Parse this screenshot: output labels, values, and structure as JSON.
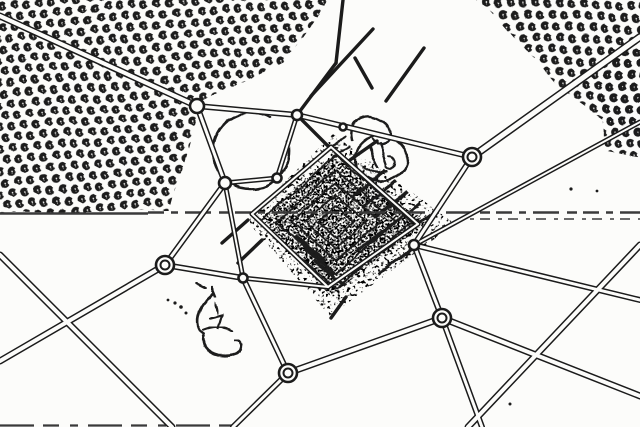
{
  "canvas": {
    "width": 640,
    "height": 427
  },
  "colors": {
    "background": "#fcfcfa",
    "ink": "#1b1b1b",
    "ink_soft": "#3a3a3a",
    "white": "#fcfcfa"
  },
  "scene": {
    "description": "edge-detected aerial photograph: central stepped pyramid monument with radiating footpaths, junction circles, orchard tree rows in top corners",
    "patterns": [
      {
        "id": "treeRowsA",
        "tile_w": 21,
        "tile_h": 13,
        "rotate": 27,
        "stroke_width": 2,
        "blob_path": "M3.4,0 A3.4,3.4 0 1 1 0.6,-3.3 M1.8,0.3 A1.8,1.8 0 1 0 0.2,1.8",
        "blobs": [
          [
            5,
            4
          ],
          [
            15.5,
            9.5
          ]
        ]
      },
      {
        "id": "treeRowsB",
        "tile_w": 20,
        "tile_h": 14,
        "rotate": 36,
        "stroke_width": 2.1,
        "blob_path": "M3.4,0 A3.4,3.4 0 1 1 0.6,-3.3 M1.8,0.3 A1.8,1.8 0 1 0 0.2,1.8",
        "blobs": [
          [
            4.5,
            3.5
          ],
          [
            14.5,
            9.5
          ]
        ]
      }
    ],
    "orchards": [
      {
        "name": "orchard-top-left",
        "pattern": "treeRowsA",
        "points": "-8,-8 332,-6 284,62 199,104 170,211 -8,212"
      },
      {
        "name": "orchard-top-right",
        "pattern": "treeRowsB",
        "points": "464,-8 648,-8 648,150 556,86 488,8"
      },
      {
        "name": "orchard-right-strip",
        "pattern": "treeRowsB",
        "points": "600,52 646,36 646,158 604,150"
      }
    ],
    "speckles": [
      {
        "name": "pyramid-noise-outer",
        "clip": "clipOuter",
        "filter": "spkSparse",
        "points": "333,134 455,224 330,316 246,220",
        "bbox": [
          240,
          128,
          222,
          196
        ]
      },
      {
        "name": "pyramid-noise-inner",
        "clip": "clipInner",
        "filter": "spkDense",
        "points": "333,156 426,223 330,296 262,217",
        "bbox": [
          256,
          150,
          178,
          154
        ]
      }
    ],
    "pyramid": {
      "cx": 336,
      "cy": 222,
      "rx": 93,
      "ry": 81,
      "levels": [
        0.82,
        0.64,
        0.48,
        0.33,
        0.19
      ],
      "stroke_width": 1.8
    },
    "hatches": [
      [
        352,
        196,
        386,
        170
      ],
      [
        363,
        207,
        397,
        181
      ],
      [
        374,
        218,
        408,
        192
      ],
      [
        385,
        229,
        419,
        203
      ],
      [
        396,
        240,
        430,
        214
      ],
      [
        356,
        252,
        390,
        226
      ],
      [
        367,
        263,
        401,
        237
      ],
      [
        378,
        274,
        412,
        248
      ],
      [
        296,
        236,
        326,
        262
      ],
      [
        305,
        248,
        335,
        274
      ],
      [
        314,
        260,
        344,
        286
      ]
    ],
    "decor": [
      {
        "name": "open-arc-ring",
        "d": "M270,118 A38,38 0 1 0 288,142",
        "w": 2.6
      },
      {
        "name": "fountain-circle",
        "d": "M355,158 a26,23 0 1 0 52,0 a26,23 0 1 0 -52,0",
        "w": 2.4
      },
      {
        "name": "fountain-top-loop",
        "d": "M352,141 C348,123 362,112 375,117 C388,121 394,133 387,142 C383,147 375,146 372,139",
        "w": 2.4
      },
      {
        "name": "fountain-mark",
        "d": "M369,148 l9,19",
        "w": 2.2
      },
      {
        "name": "fountain-mark",
        "d": "M380,144 l7,21",
        "w": 2.2
      },
      {
        "name": "fountain-mark",
        "d": "M363,166 q11,9 24,5",
        "w": 2.2
      },
      {
        "name": "fountain-mark",
        "d": "M389,157 a5,6 0 1 1 -3,9",
        "w": 2
      },
      {
        "name": "fountain-hatch",
        "d": "M345,137 l-13,8",
        "w": 2.2
      },
      {
        "name": "fountain-hatch",
        "d": "M349,147 l-15,9",
        "w": 2.2
      },
      {
        "name": "ground-squiggle",
        "d": "M196,283 l10,5",
        "w": 2.4
      },
      {
        "name": "ground-squiggle",
        "d": "M212,286 l4,10",
        "w": 2.4
      },
      {
        "name": "ground-squiggle",
        "d": "M214,293 C206,300 200,306 199,314 C196,322 198,330 204,334",
        "w": 2.6
      },
      {
        "name": "ground-squiggle",
        "d": "M204,334 C200,344 206,352 218,355 C228,357 238,355 241,349",
        "w": 2.6
      },
      {
        "name": "ground-squiggle",
        "d": "M241,349 C243,344 240,341 235,341",
        "w": 2.2
      },
      {
        "name": "ground-squiggle",
        "d": "M204,330 C214,326 226,326 233,331",
        "w": 2.4
      },
      {
        "name": "ground-squiggle",
        "d": "M210,318 l12,-3 l-4,14",
        "w": 2.2
      },
      {
        "name": "ground-squiggle",
        "d": "M215,300 l3,13",
        "w": 2.2
      }
    ],
    "seams": [
      {
        "name": "tile-seam-solid",
        "x1": 0,
        "y1": 213.5,
        "x2": 148,
        "y2": 213.5,
        "w": 2.6,
        "dash": ""
      },
      {
        "name": "tile-seam-dashed",
        "x1": 148,
        "y1": 212.5,
        "x2": 640,
        "y2": 212.5,
        "w": 2.4,
        "dash": "16 7 7 7 26 8 10 6"
      },
      {
        "name": "tile-seam-dashed",
        "x1": 470,
        "y1": 219,
        "x2": 640,
        "y2": 219,
        "w": 1.6,
        "dash": "4 6 10 8"
      },
      {
        "name": "bottom-edge-line",
        "x1": 0,
        "y1": 425.5,
        "x2": 235,
        "y2": 425.5,
        "w": 2.2,
        "dash": "34 9 16 11 8 10"
      }
    ],
    "roads": [
      [
        0,
        16,
        197,
        106,
        7
      ],
      [
        197,
        106,
        297,
        115,
        6
      ],
      [
        197,
        106,
        225,
        183,
        6
      ],
      [
        225,
        183,
        165,
        265,
        6
      ],
      [
        225,
        183,
        277,
        178,
        5
      ],
      [
        277,
        178,
        297,
        115,
        5
      ],
      [
        225,
        183,
        243,
        278,
        5
      ],
      [
        165,
        265,
        243,
        278,
        6
      ],
      [
        165,
        265,
        0,
        361,
        7
      ],
      [
        0,
        255,
        172,
        427,
        7
      ],
      [
        243,
        278,
        288,
        373,
        6
      ],
      [
        288,
        373,
        233,
        427,
        6
      ],
      [
        288,
        373,
        442,
        318,
        7
      ],
      [
        442,
        318,
        482,
        427,
        6
      ],
      [
        442,
        318,
        640,
        396,
        7
      ],
      [
        640,
        245,
        468,
        427,
        7
      ],
      [
        414,
        245,
        442,
        318,
        6
      ],
      [
        472,
        157,
        414,
        245,
        6
      ],
      [
        297,
        115,
        472,
        157,
        6
      ],
      [
        472,
        157,
        640,
        37,
        8
      ],
      [
        640,
        122,
        414,
        245,
        5
      ],
      [
        414,
        245,
        640,
        300,
        6
      ],
      [
        297,
        115,
        336,
        63,
        4
      ],
      [
        336,
        63,
        343,
        0,
        4
      ],
      [
        311,
        96,
        373,
        29,
        4
      ],
      [
        355,
        58,
        372,
        88,
        4
      ],
      [
        297,
        115,
        331,
        149,
        4
      ],
      [
        331,
        147,
        252,
        214,
        5
      ],
      [
        252,
        214,
        328,
        287,
        5
      ],
      [
        328,
        287,
        418,
        224,
        5
      ],
      [
        418,
        224,
        331,
        147,
        5
      ],
      [
        243,
        278,
        328,
        287,
        5
      ],
      [
        248,
        220,
        222,
        243,
        4
      ],
      [
        262,
        240,
        238,
        263,
        4
      ],
      [
        350,
        160,
        377,
        141,
        4
      ],
      [
        346,
        297,
        331,
        318,
        4
      ],
      [
        424,
        48,
        386,
        101,
        4
      ]
    ],
    "nodes": [
      [
        197,
        106,
        7,
        0
      ],
      [
        297,
        115,
        5,
        0
      ],
      [
        472,
        157,
        9,
        1
      ],
      [
        414,
        245,
        5,
        0
      ],
      [
        442,
        318,
        9,
        1
      ],
      [
        288,
        373,
        9,
        1
      ],
      [
        243,
        278,
        4.5,
        0
      ],
      [
        165,
        265,
        9,
        1
      ],
      [
        225,
        183,
        6,
        0
      ],
      [
        277,
        178,
        4.5,
        0
      ],
      [
        343,
        127,
        3.5,
        0
      ]
    ],
    "dots": [
      [
        168,
        300,
        1.4
      ],
      [
        175,
        303,
        1.6
      ],
      [
        181,
        307,
        1.8
      ],
      [
        186,
        313,
        1.5
      ],
      [
        510,
        404,
        1.5
      ],
      [
        571,
        189,
        1.6
      ],
      [
        597,
        191,
        1.4
      ]
    ]
  }
}
